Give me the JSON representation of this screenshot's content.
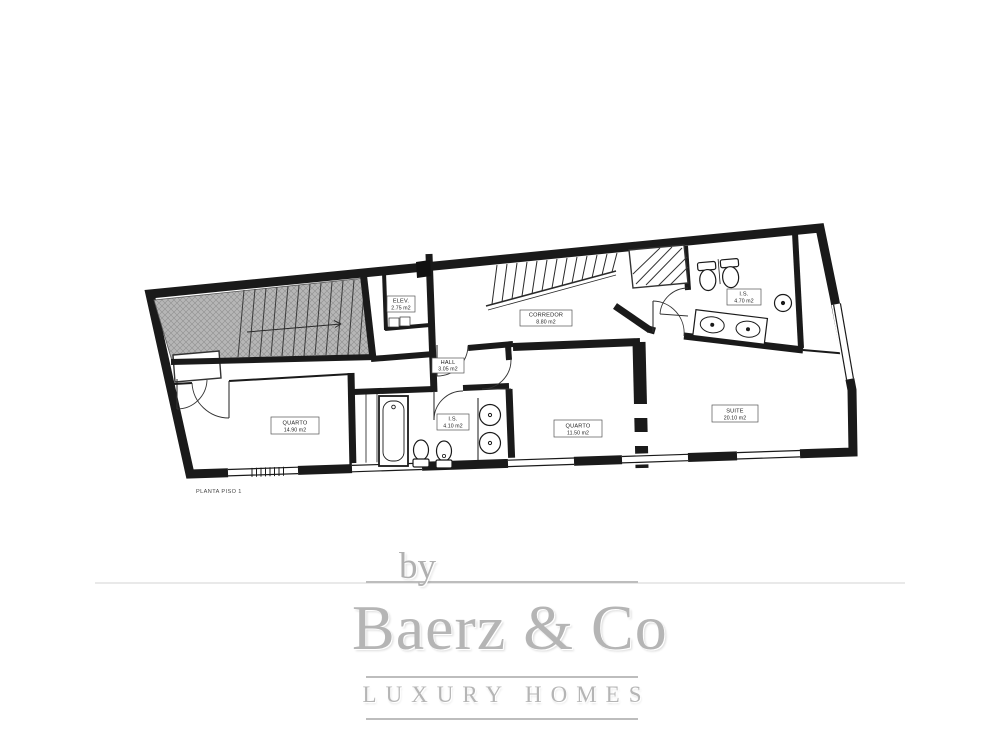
{
  "plan": {
    "drawing_title": "PLANTA PISO 1",
    "rooms": {
      "quarto1": {
        "name": "QUARTO",
        "area": "14.90 m2"
      },
      "bathroom1": {
        "name": "I.S.",
        "area": "4.10 m2"
      },
      "quarto2": {
        "name": "QUARTO",
        "area": "11.50 m2"
      },
      "suite": {
        "name": "SUITE",
        "area": "20.10 m2"
      },
      "hall": {
        "name": "HALL",
        "area": "3.05 m2"
      },
      "corredor": {
        "name": "CORREDOR",
        "area": "8.80 m2"
      },
      "elev": {
        "name": "ELEV.",
        "area": "2.75 m2"
      },
      "bathroom2": {
        "name": "I.S.",
        "area": "4.70 m2"
      }
    }
  },
  "branding": {
    "by": "by",
    "name": "Baerz & Co",
    "tagline": "LUXURY HOMES"
  },
  "colors": {
    "plan_line": "#1a1a1a",
    "stair_fill": "#b6b6b6",
    "logo_gray": "#b5b5b5"
  }
}
